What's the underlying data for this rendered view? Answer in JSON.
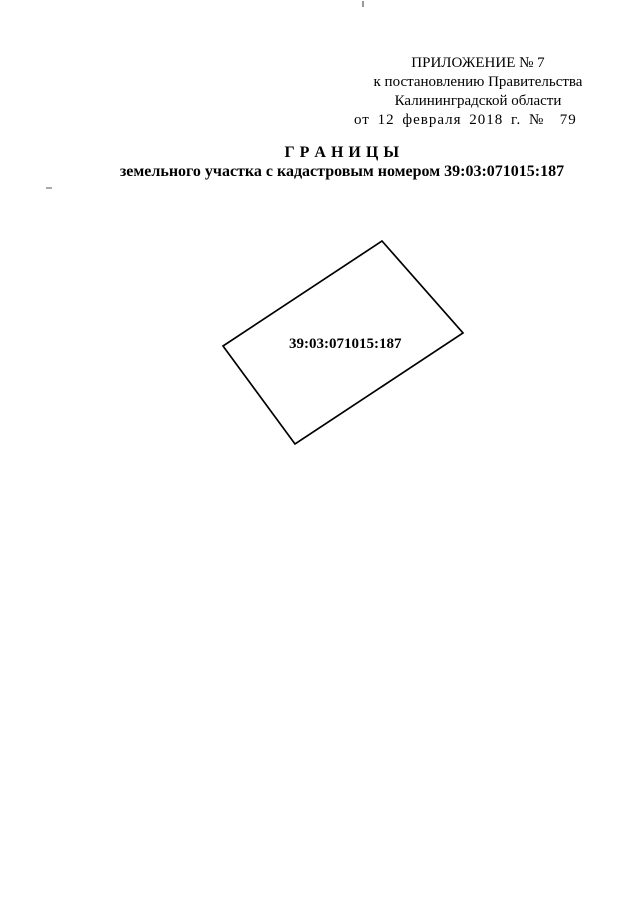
{
  "document": {
    "header": {
      "line1": "ПРИЛОЖЕНИЕ № 7",
      "line2": "к постановлению Правительства",
      "line3": "Калининградской области",
      "date_line": "от 12 февраля 2018 г. №  79"
    },
    "title": "Г Р А Н И Ц Ы",
    "subtitle": "земельного участка с кадастровым номером 39:03:071015:187",
    "parcel": {
      "cadastral_number": "39:03:071015:187"
    }
  },
  "diagram": {
    "type": "parcel-boundary-plan",
    "polygon_points": "382,241 463,333 295,444 223,346",
    "stroke_color": "#000000",
    "fill_color": "none",
    "page_background": "#ffffff",
    "text_color": "#000000"
  }
}
